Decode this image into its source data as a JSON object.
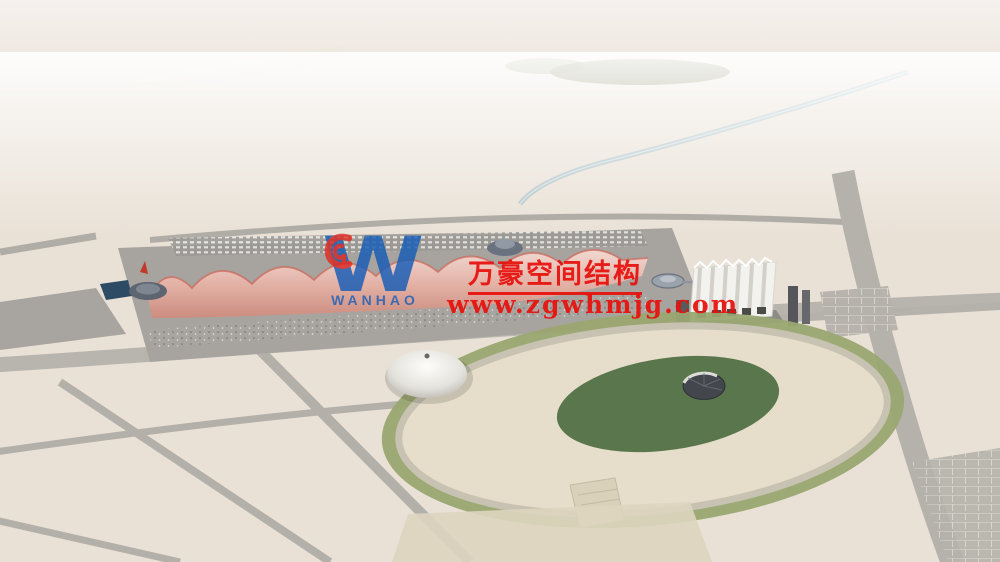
{
  "scene": {
    "description": "Aerial rendering: exhibition center with white gridshell halls and red wave membrane roof spine, vaulted side hall, rooftop solar farms, oval landscaped park with tent dome and glass cone, farmland horizon, surrounding city blocks and clouds",
    "colors": {
      "sky_haze": "#f4efe9",
      "farmland_green": "#8fa05e",
      "farmland_tan": "#c9b98f",
      "hall_roof": "#eef1f3",
      "membrane_red": "#d9948a",
      "plaza_gray": "#a7a49f",
      "park_sand": "#e6deca",
      "solar_panel": "#2e4a68",
      "tree_green": "#46663a"
    }
  },
  "watermark": {
    "title": "万豪空间结构",
    "url": "www.zgwhmjg.com",
    "text_color": "#e8100c",
    "logo": {
      "letter": "W",
      "wordmark": "WANHAO",
      "blue": "#1a5fb8",
      "red": "#e32219"
    }
  }
}
